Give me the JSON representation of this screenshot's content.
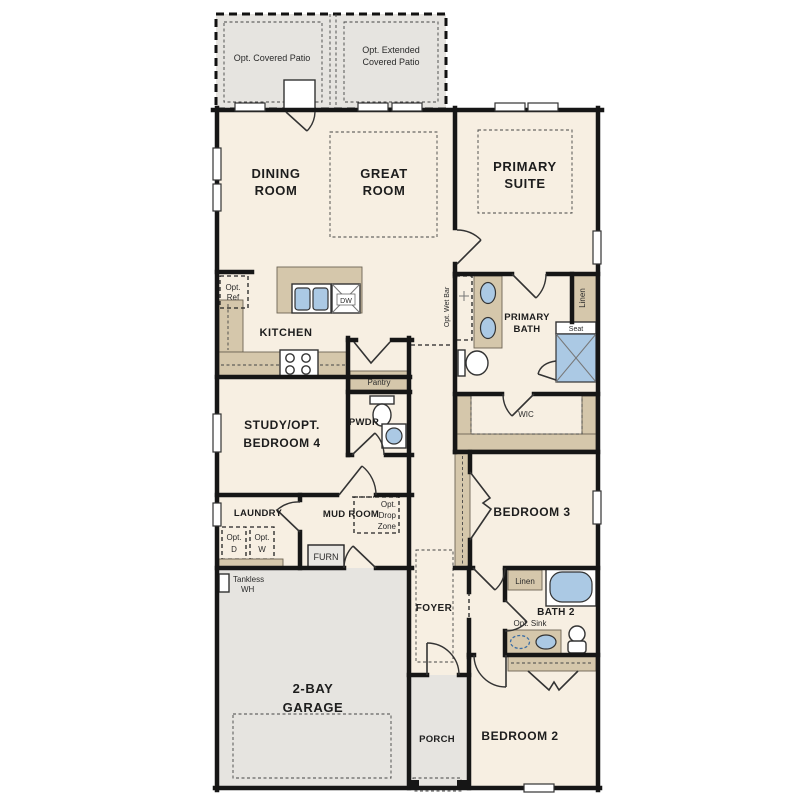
{
  "palette": {
    "floor": "#f7efe2",
    "concrete": "#e6e4e0",
    "counter": "#d5c7ab",
    "wall": "#161616",
    "fixture_blue": "#abc9e4",
    "background": "#ffffff"
  },
  "labels": {
    "patio_covered": "Opt. Covered Patio",
    "patio_extended_1": "Opt. Extended",
    "patio_extended_2": "Covered Patio",
    "dining_1": "DINING",
    "dining_2": "ROOM",
    "great_1": "GREAT",
    "great_2": "ROOM",
    "primary_suite_1": "PRIMARY",
    "primary_suite_2": "SUITE",
    "kitchen": "KITCHEN",
    "opt_ref_1": "Opt.",
    "opt_ref_2": "Ref",
    "dw": "DW",
    "pantry": "Pantry",
    "opt_wet_bar": "Opt. Wet Bar",
    "primary_bath_1": "PRIMARY",
    "primary_bath_2": "BATH",
    "linen_primary": "Linen",
    "seat": "Seat",
    "wic": "WIC",
    "study_1": "STUDY/OPT.",
    "study_2": "BEDROOM 4",
    "pwdr": "PWDR",
    "bedroom3": "BEDROOM 3",
    "laundry": "LAUNDRY",
    "opt_d_1": "Opt.",
    "opt_d_2": "D",
    "opt_w_1": "Opt.",
    "opt_w_2": "W",
    "mud_room": "MUD ROOM",
    "opt_drop_1": "Opt.",
    "opt_drop_2": "Drop",
    "opt_drop_3": "Zone",
    "furn": "FURN",
    "tankless_1": "Tankless",
    "tankless_2": "WH",
    "garage_1": "2-BAY",
    "garage_2": "GARAGE",
    "foyer": "FOYER",
    "porch": "PORCH",
    "linen_bath2": "Linen",
    "bath2": "BATH 2",
    "opt_sink": "Opt. Sink",
    "bedroom2": "BEDROOM 2"
  }
}
